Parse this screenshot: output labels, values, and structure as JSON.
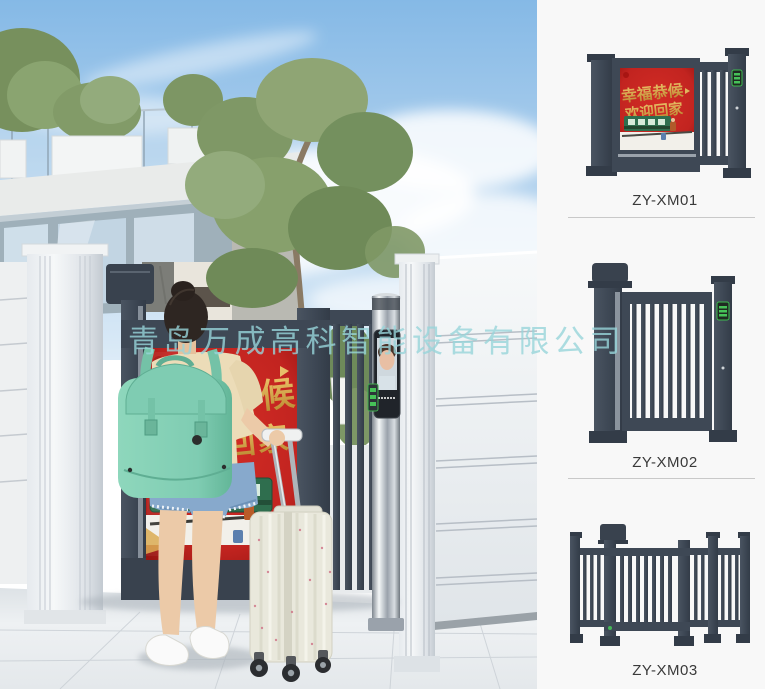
{
  "watermark": {
    "text": "青岛万成高科智能设备有限公司",
    "color": "#9ed8dc"
  },
  "scene": {
    "description": "woman with mint backpack and suitcase standing at smart advertising pedestrian gate",
    "poster": {
      "line1": "幸福恭候",
      "line2": "欢迎回家"
    }
  },
  "products": [
    {
      "model": "ZY-XM01",
      "poster": {
        "line1": "幸福恭候",
        "line2": "欢迎回家"
      }
    },
    {
      "model": "ZY-XM02"
    },
    {
      "model": "ZY-XM03"
    }
  ],
  "colors": {
    "gate_dark": "#3e4855",
    "poster_red": "#c22420",
    "poster_gold": "#d9a84a",
    "train_green": "#2f6e4e",
    "backpack_mint": "#7fccb2",
    "denim_blue": "#87a9cc",
    "steel_silver": "#b9bfc6",
    "panel_background": "#f8f8f8",
    "label_text": "#3a3a3a",
    "divider": "#c9c9c9"
  }
}
